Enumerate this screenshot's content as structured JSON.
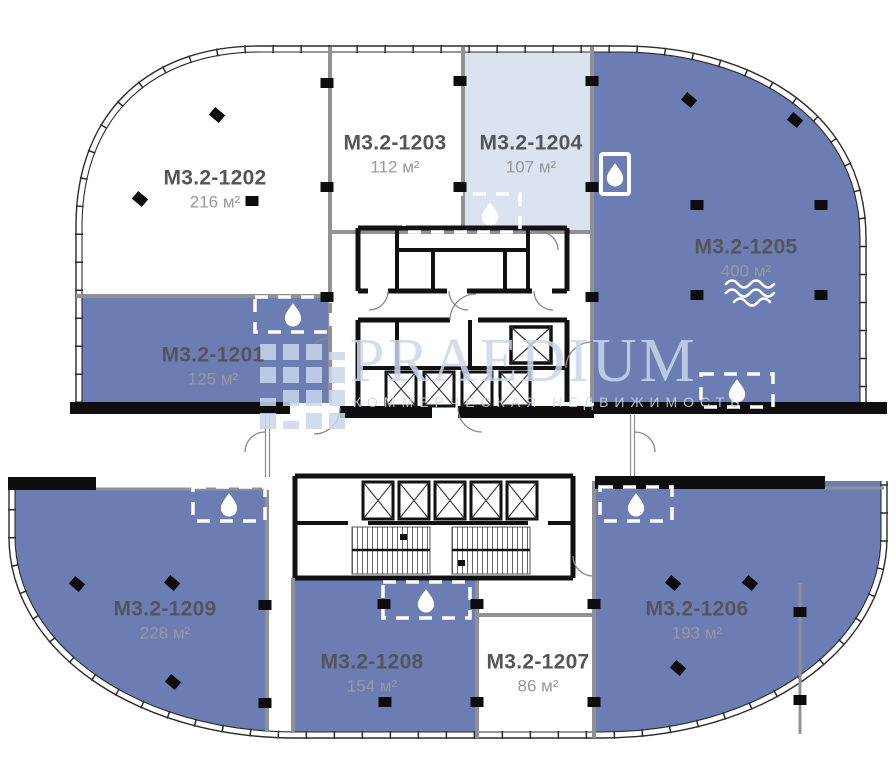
{
  "watermark": {
    "brand": "PRAEDIUM",
    "tagline": "КОММЕРЧЕСКАЯ НЕДВИЖИМОСТЬ"
  },
  "units": [
    {
      "id": "M3.2-1201",
      "area": "125 м²",
      "fill": "blue"
    },
    {
      "id": "M3.2-1202",
      "area": "216 м²",
      "fill": "white"
    },
    {
      "id": "M3.2-1203",
      "area": "112 м²",
      "fill": "white"
    },
    {
      "id": "M3.2-1204",
      "area": "107 м²",
      "fill": "lightblue"
    },
    {
      "id": "M3.2-1205",
      "area": "400 м²",
      "fill": "blue",
      "icon": "water-waves"
    },
    {
      "id": "M3.2-1206",
      "area": "193 м²",
      "fill": "blue"
    },
    {
      "id": "M3.2-1207",
      "area": "86 м²",
      "fill": "white"
    },
    {
      "id": "M3.2-1208",
      "area": "154 м²",
      "fill": "blue"
    },
    {
      "id": "M3.2-1209",
      "area": "228 м²",
      "fill": "blue"
    }
  ],
  "icons": {
    "wet_point": "water-drop-icon",
    "water_feature": "water-waves-icon"
  },
  "colors": {
    "unit-blue": "#6b7db3",
    "unit-lightblue": "#dce3f0",
    "wall-black": "#111111",
    "wall-grey": "#909095",
    "facade": "#2c2c2c",
    "label-title": "#53555a",
    "label-area": "#96989d"
  }
}
